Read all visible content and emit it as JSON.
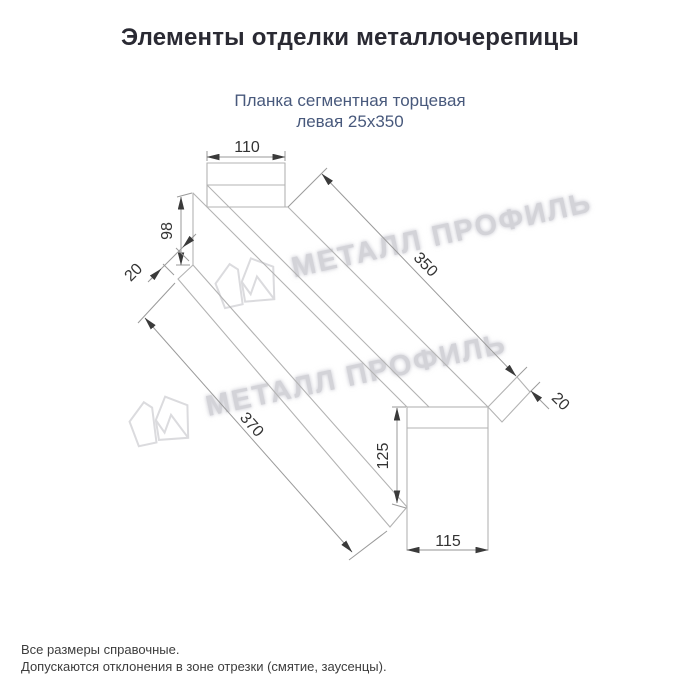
{
  "title": "Элементы отделки металлочерепицы",
  "subtitle": {
    "line1": "Планка сегментная торцевая",
    "line2": "левая 25х350"
  },
  "drawing": {
    "dims": {
      "top_width": "110",
      "left_height": "98",
      "left_hem": "20",
      "length_top": "350",
      "right_hem": "20",
      "length_bottom": "370",
      "right_height": "125",
      "right_width": "115"
    }
  },
  "watermark": {
    "text": "МЕТАЛЛ ПРОФИЛЬ"
  },
  "footer": {
    "line1": "Все размеры справочные.",
    "line2": "Допускаются отклонения в зоне отрезки (смятие, заусенцы)."
  },
  "colors": {
    "title_text": "#2a2a33",
    "subtitle_text": "#48597c",
    "shape_lines": "#b3b3b3",
    "dimension_lines": "#999999",
    "dimension_text": "#333333",
    "watermark": "#d3d3d8",
    "background": "#ffffff"
  }
}
